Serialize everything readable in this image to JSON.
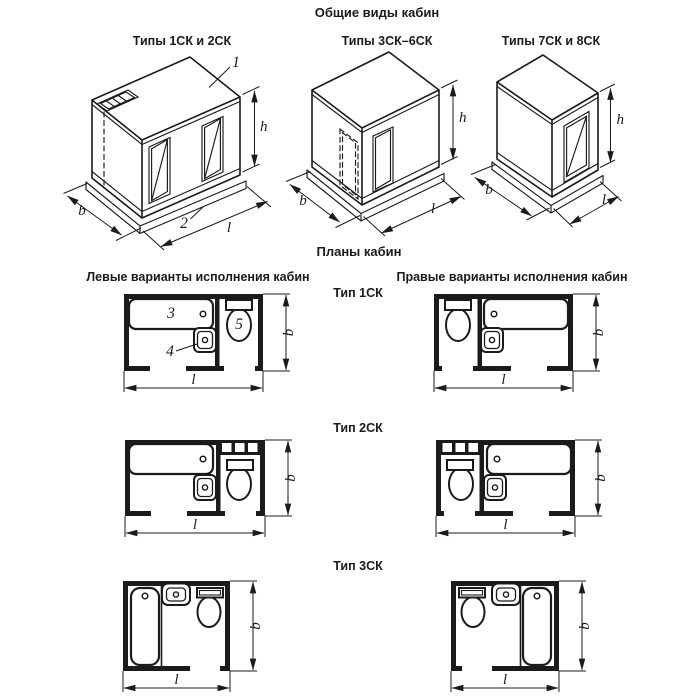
{
  "drawing": {
    "title": "Общие виды кабин",
    "plans_title": "Планы кабин",
    "left_column_header": "Левые варианты исполнения кабин",
    "right_column_header": "Правые варианты исполнения кабин"
  },
  "iso_views": [
    {
      "caption": "Типы 1СК и 2СК",
      "part_labels": {
        "ceiling_panel": "1",
        "floor_panel": "2"
      }
    },
    {
      "caption": "Типы 3СК–6СК"
    },
    {
      "caption": "Типы 7СК и 8СК"
    }
  ],
  "plan_rows": [
    {
      "type_label": "Тип 1СК",
      "part_labels": {
        "bathtub": "3",
        "washbasin": "4",
        "toilet": "5"
      }
    },
    {
      "type_label": "Тип 2СК"
    },
    {
      "type_label": "Тип 3СК"
    }
  ],
  "dim_letters": {
    "b": "b",
    "l": "l",
    "h": "h"
  }
}
